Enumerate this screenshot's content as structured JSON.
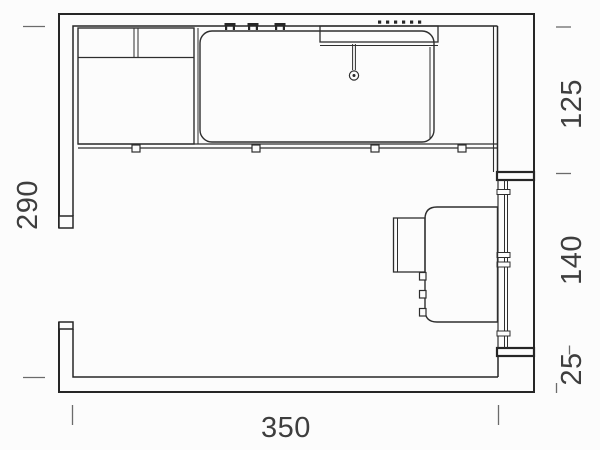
{
  "plan": {
    "type": "floor-plan-drawing",
    "dimensions": {
      "left": "290",
      "right_top": "125",
      "right_middle": "140",
      "right_bottom": "25",
      "bottom": "350"
    },
    "colors": {
      "line": "#262626",
      "dimension_text": "#3e3e3e",
      "background": "#fcfcfc"
    }
  }
}
